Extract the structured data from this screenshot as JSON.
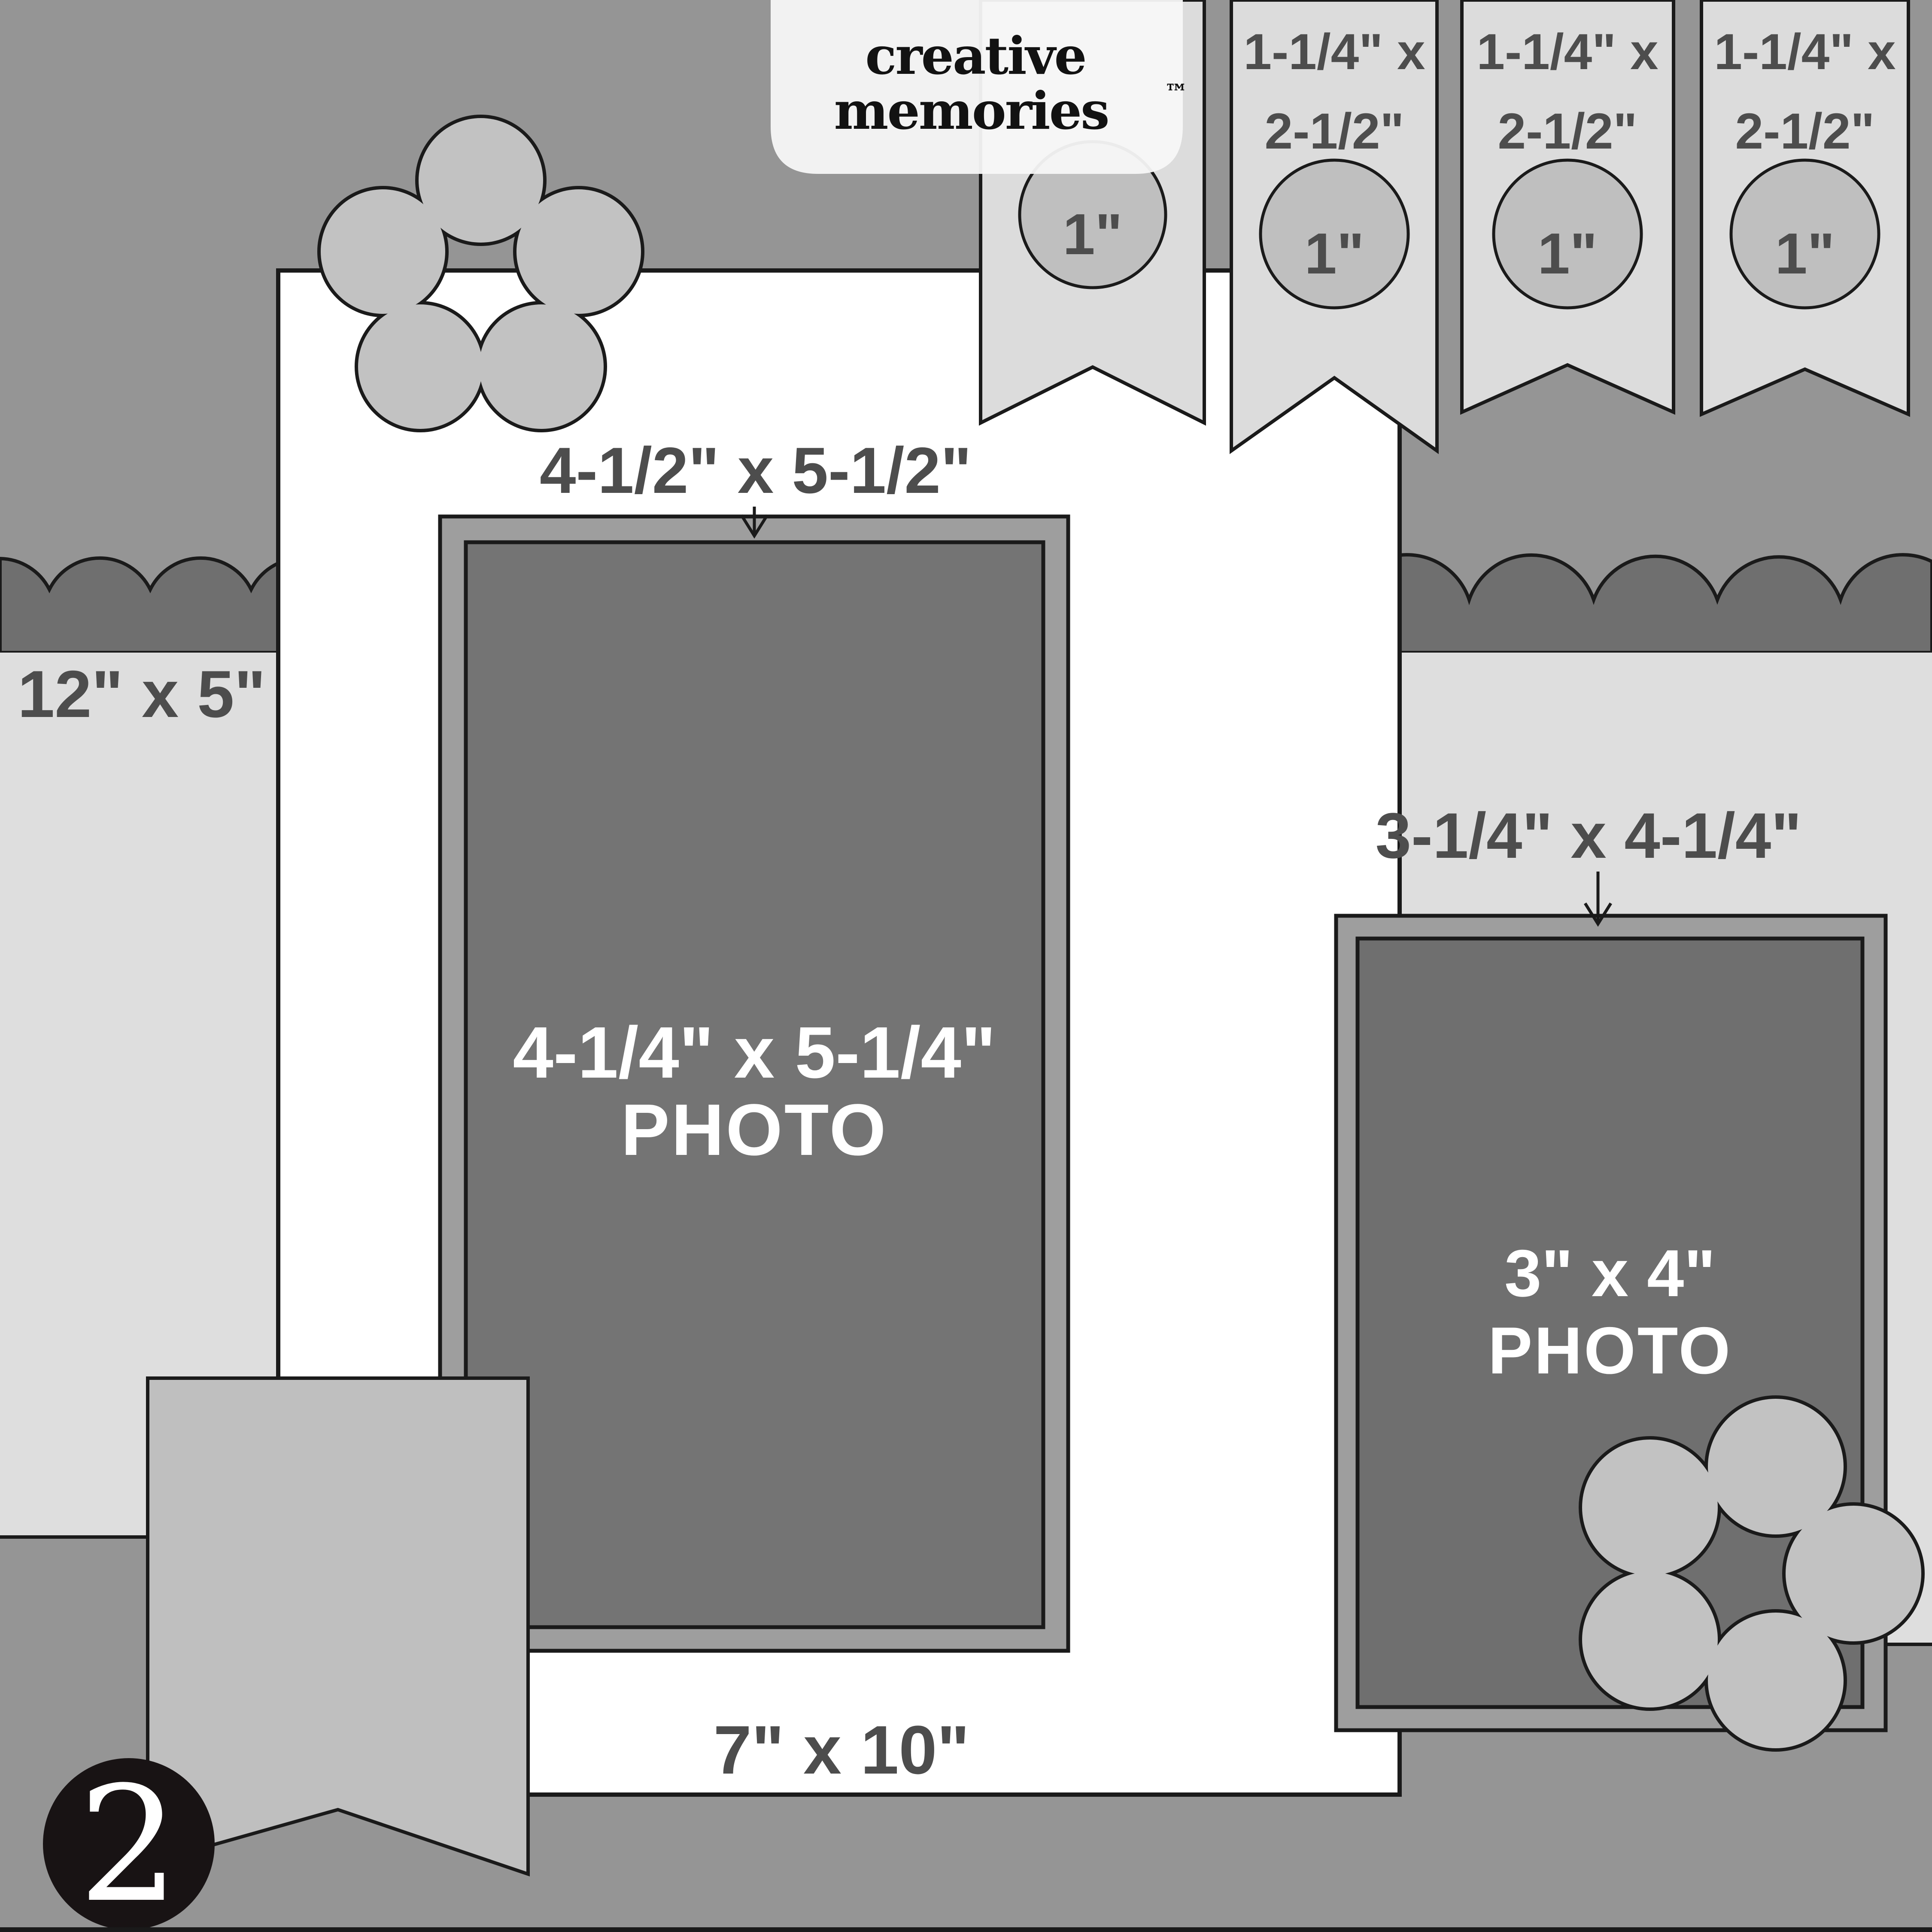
{
  "logo": {
    "line1": "creative",
    "line2": "memories",
    "tm": "™"
  },
  "pennants": {
    "items": [
      {
        "circle": "1\""
      },
      {
        "line1": "1-1/4\" x",
        "line2": "2-1/2\"",
        "circle": "1\""
      },
      {
        "line1": "1-1/4\" x",
        "line2": "2-1/2\"",
        "circle": "1\""
      },
      {
        "line1": "1-1/4\" x",
        "line2": "2-1/2\"",
        "circle": "1\""
      }
    ]
  },
  "left_panel": {
    "label": "12\" x 5\""
  },
  "page": {
    "label": "7\" x 10\""
  },
  "main_photo": {
    "mat_label": "4-1/2\" x 5-1/2\"",
    "line1": "4-1/4\" x 5-1/4\"",
    "line2": "PHOTO"
  },
  "right_photo": {
    "mat_label": "3-1/4\" x 4-1/4\"",
    "line1": "3\" x 4\"",
    "line2": "PHOTO"
  },
  "badge": {
    "number": "2"
  },
  "colors": {
    "background": "#959595",
    "scallop_band": "#6f6f6f",
    "side_panel": "#dedede",
    "page_white": "#ffffff",
    "pennant": "#dcdcdc",
    "pennant_circle": "#bfbfbf",
    "flower": "#c2c2c2",
    "banner": "#bfbfbf",
    "mat": "#9e9e9e",
    "main_photo": "#747474",
    "right_photo": "#6f6f6f",
    "outline": "#1a1a1a",
    "label_text": "#4d4d4d",
    "badge_black": "#181314"
  }
}
